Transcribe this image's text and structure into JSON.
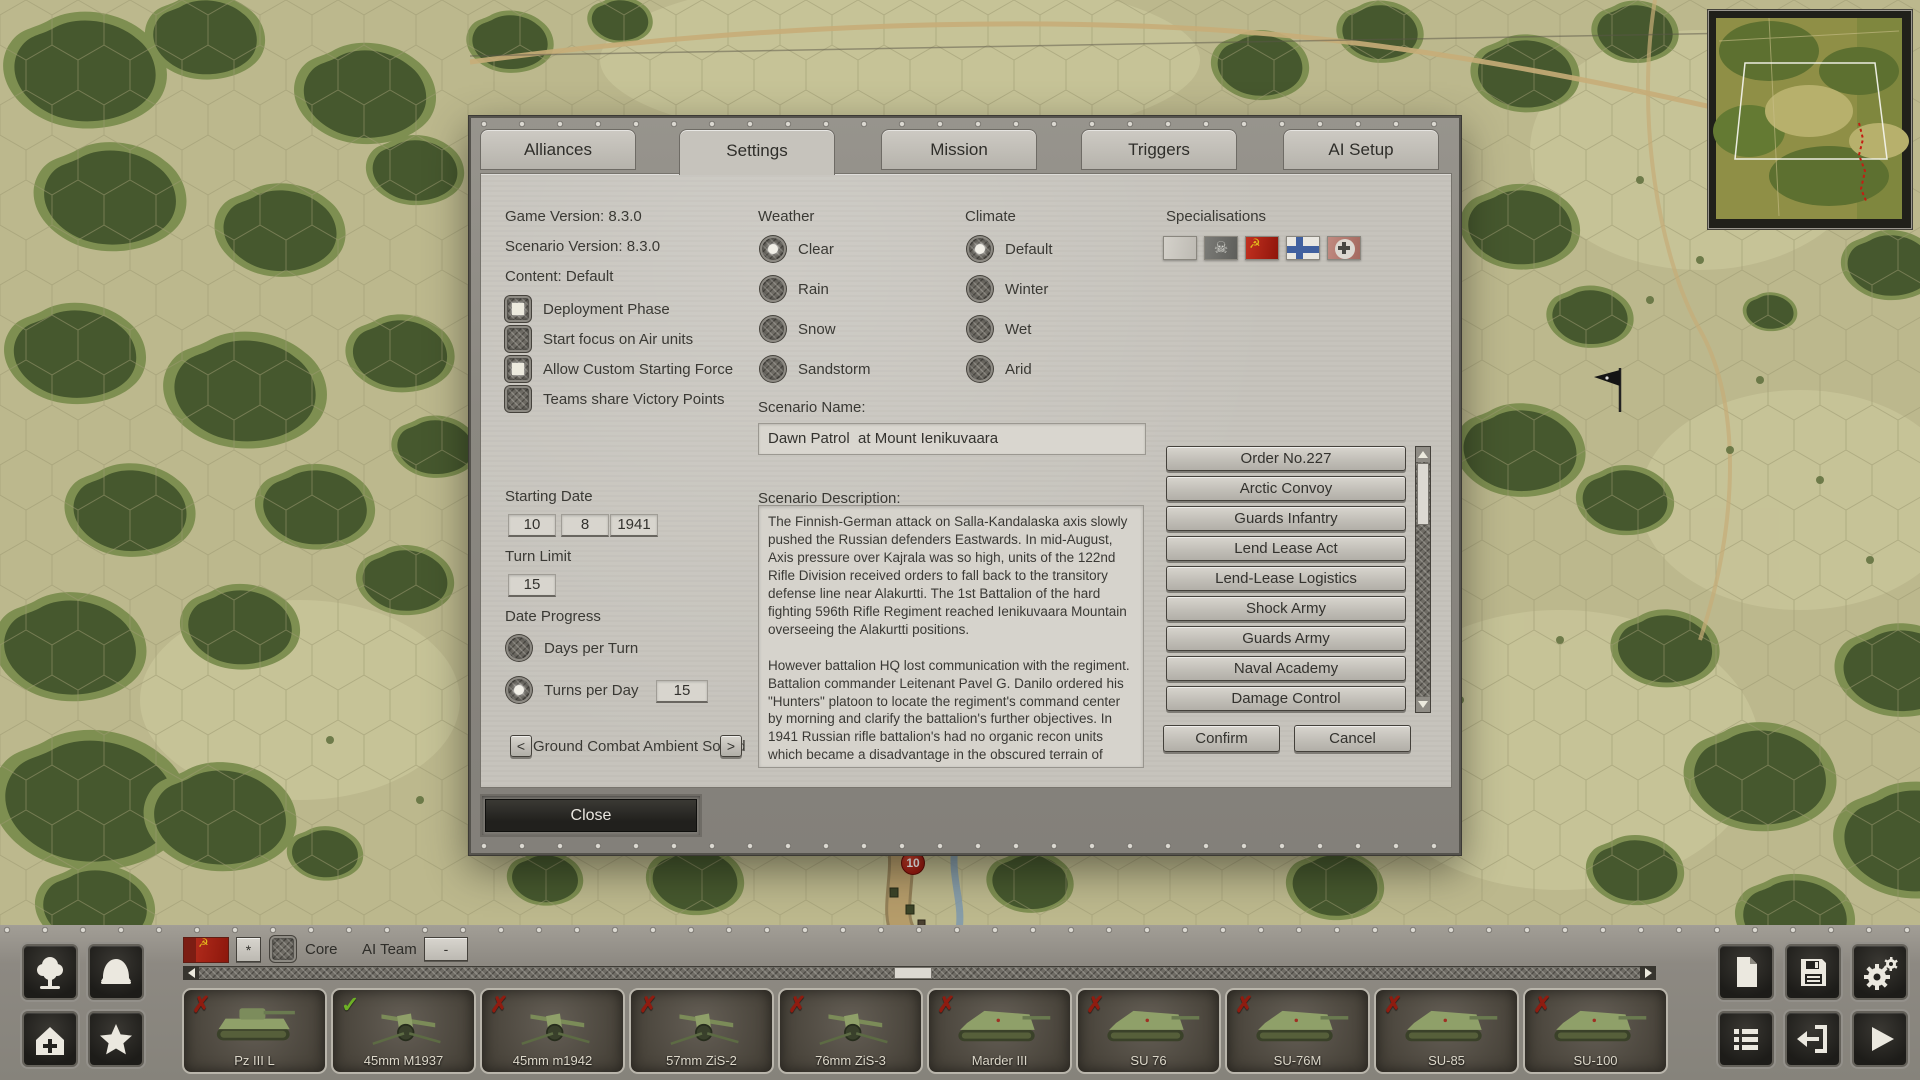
{
  "colors": {
    "accent_red": "#8f1c10",
    "check_green": "#6db025",
    "soviet_red": "#a32417",
    "finnish_blue": "#40609f"
  },
  "dialog": {
    "tabs": [
      {
        "label": "Alliances"
      },
      {
        "label": "Settings",
        "active": true
      },
      {
        "label": "Mission"
      },
      {
        "label": "Triggers"
      },
      {
        "label": "AI Setup"
      }
    ],
    "info": {
      "game_version": "Game Version: 8.3.0",
      "scenario_version": "Scenario Version: 8.3.0",
      "content": "Content: Default"
    },
    "options": [
      {
        "label": "Deployment Phase",
        "checked": true
      },
      {
        "label": "Start focus on Air units"
      },
      {
        "label": "Allow Custom Starting Force",
        "checked": true
      },
      {
        "label": "Teams share Victory Points"
      }
    ],
    "starting_date": {
      "label": "Starting Date",
      "day": "10",
      "month": "8",
      "year": "1941"
    },
    "turn_limit": {
      "label": "Turn Limit",
      "value": "15"
    },
    "date_progress": {
      "label": "Date Progress",
      "options": [
        {
          "label": "Days per Turn"
        },
        {
          "label": "Turns per Day",
          "selected": true,
          "value": "15"
        }
      ]
    },
    "ambient": {
      "prev": "<",
      "label": "Ground Combat Ambient Sound",
      "next": ">"
    },
    "weather": {
      "label": "Weather",
      "options": [
        {
          "label": "Clear",
          "selected": true
        },
        {
          "label": "Rain"
        },
        {
          "label": "Snow"
        },
        {
          "label": "Sandstorm"
        }
      ]
    },
    "climate": {
      "label": "Climate",
      "options": [
        {
          "label": "Default",
          "selected": true
        },
        {
          "label": "Winter"
        },
        {
          "label": "Wet"
        },
        {
          "label": "Arid"
        }
      ]
    },
    "scenario_name": {
      "label": "Scenario Name:",
      "value": "Dawn Patrol  at Mount Ienikuvaara"
    },
    "scenario_description": {
      "label": "Scenario Description:",
      "text": "The Finnish-German attack on Salla-Kandalaska axis slowly pushed the Russian defenders Eastwards. In mid-August, Axis pressure over Kajrala was so high, units of the 122nd Rifle Division received orders to fall back to the transitory defense line near Alakurtti. The 1st Battalion of the hard fighting 596th Rifle Regiment reached Ienikuvaara Mountain overseeing the Alakurtti positions.\n\nHowever battalion HQ lost communication with the regiment. Battalion commander Leitenant Pavel G. Danilo ordered his \"Hunters\" platoon to locate the regiment's command center by morning and clarify the battalion's further objectives. In 1941 Russian rifle battalion's had no organic recon units which became a disadvantage in the obscured terrain of Finland. Therefore, commanders formed \"hunter\" platoons consisting"
    },
    "specialisations": {
      "label": "Specialisations",
      "flags": [
        {
          "name": "blank-flag",
          "type": "blank"
        },
        {
          "name": "skull-flag",
          "type": "skull"
        },
        {
          "name": "ussr-flag",
          "type": "ussr"
        },
        {
          "name": "finland-flag",
          "type": "finland"
        },
        {
          "name": "balkenkreuz-flag",
          "type": "cross"
        }
      ]
    },
    "special_rules": [
      "Order No.227",
      "Arctic Convoy",
      "Guards Infantry",
      "Lend Lease Act",
      "Lend-Lease Logistics",
      "Shock Army",
      "Guards Army",
      "Naval Academy",
      "Damage Control"
    ],
    "confirm_label": "Confirm",
    "cancel_label": "Cancel",
    "close_label": "Close"
  },
  "bottom_bar": {
    "star_button": "*",
    "core_label": "Core",
    "ai_team_label": "AI Team",
    "ai_team_value": "-",
    "units": [
      {
        "name": "Pz III L",
        "status": "x",
        "sprite": "tank"
      },
      {
        "name": "45mm M1937",
        "status": "check",
        "sprite": "gun"
      },
      {
        "name": "45mm m1942",
        "status": "x",
        "sprite": "gun"
      },
      {
        "name": "57mm ZiS-2",
        "status": "x",
        "sprite": "gun"
      },
      {
        "name": "76mm ZiS-3",
        "status": "x",
        "sprite": "gun"
      },
      {
        "name": "Marder III",
        "status": "x",
        "sprite": "spg"
      },
      {
        "name": "SU 76",
        "status": "x",
        "sprite": "spg"
      },
      {
        "name": "SU-76M",
        "status": "x",
        "sprite": "spg"
      },
      {
        "name": "SU-85",
        "status": "x",
        "sprite": "spg"
      },
      {
        "name": "SU-100",
        "status": "x",
        "sprite": "spg"
      }
    ]
  },
  "map": {
    "unit_badge": "10"
  }
}
